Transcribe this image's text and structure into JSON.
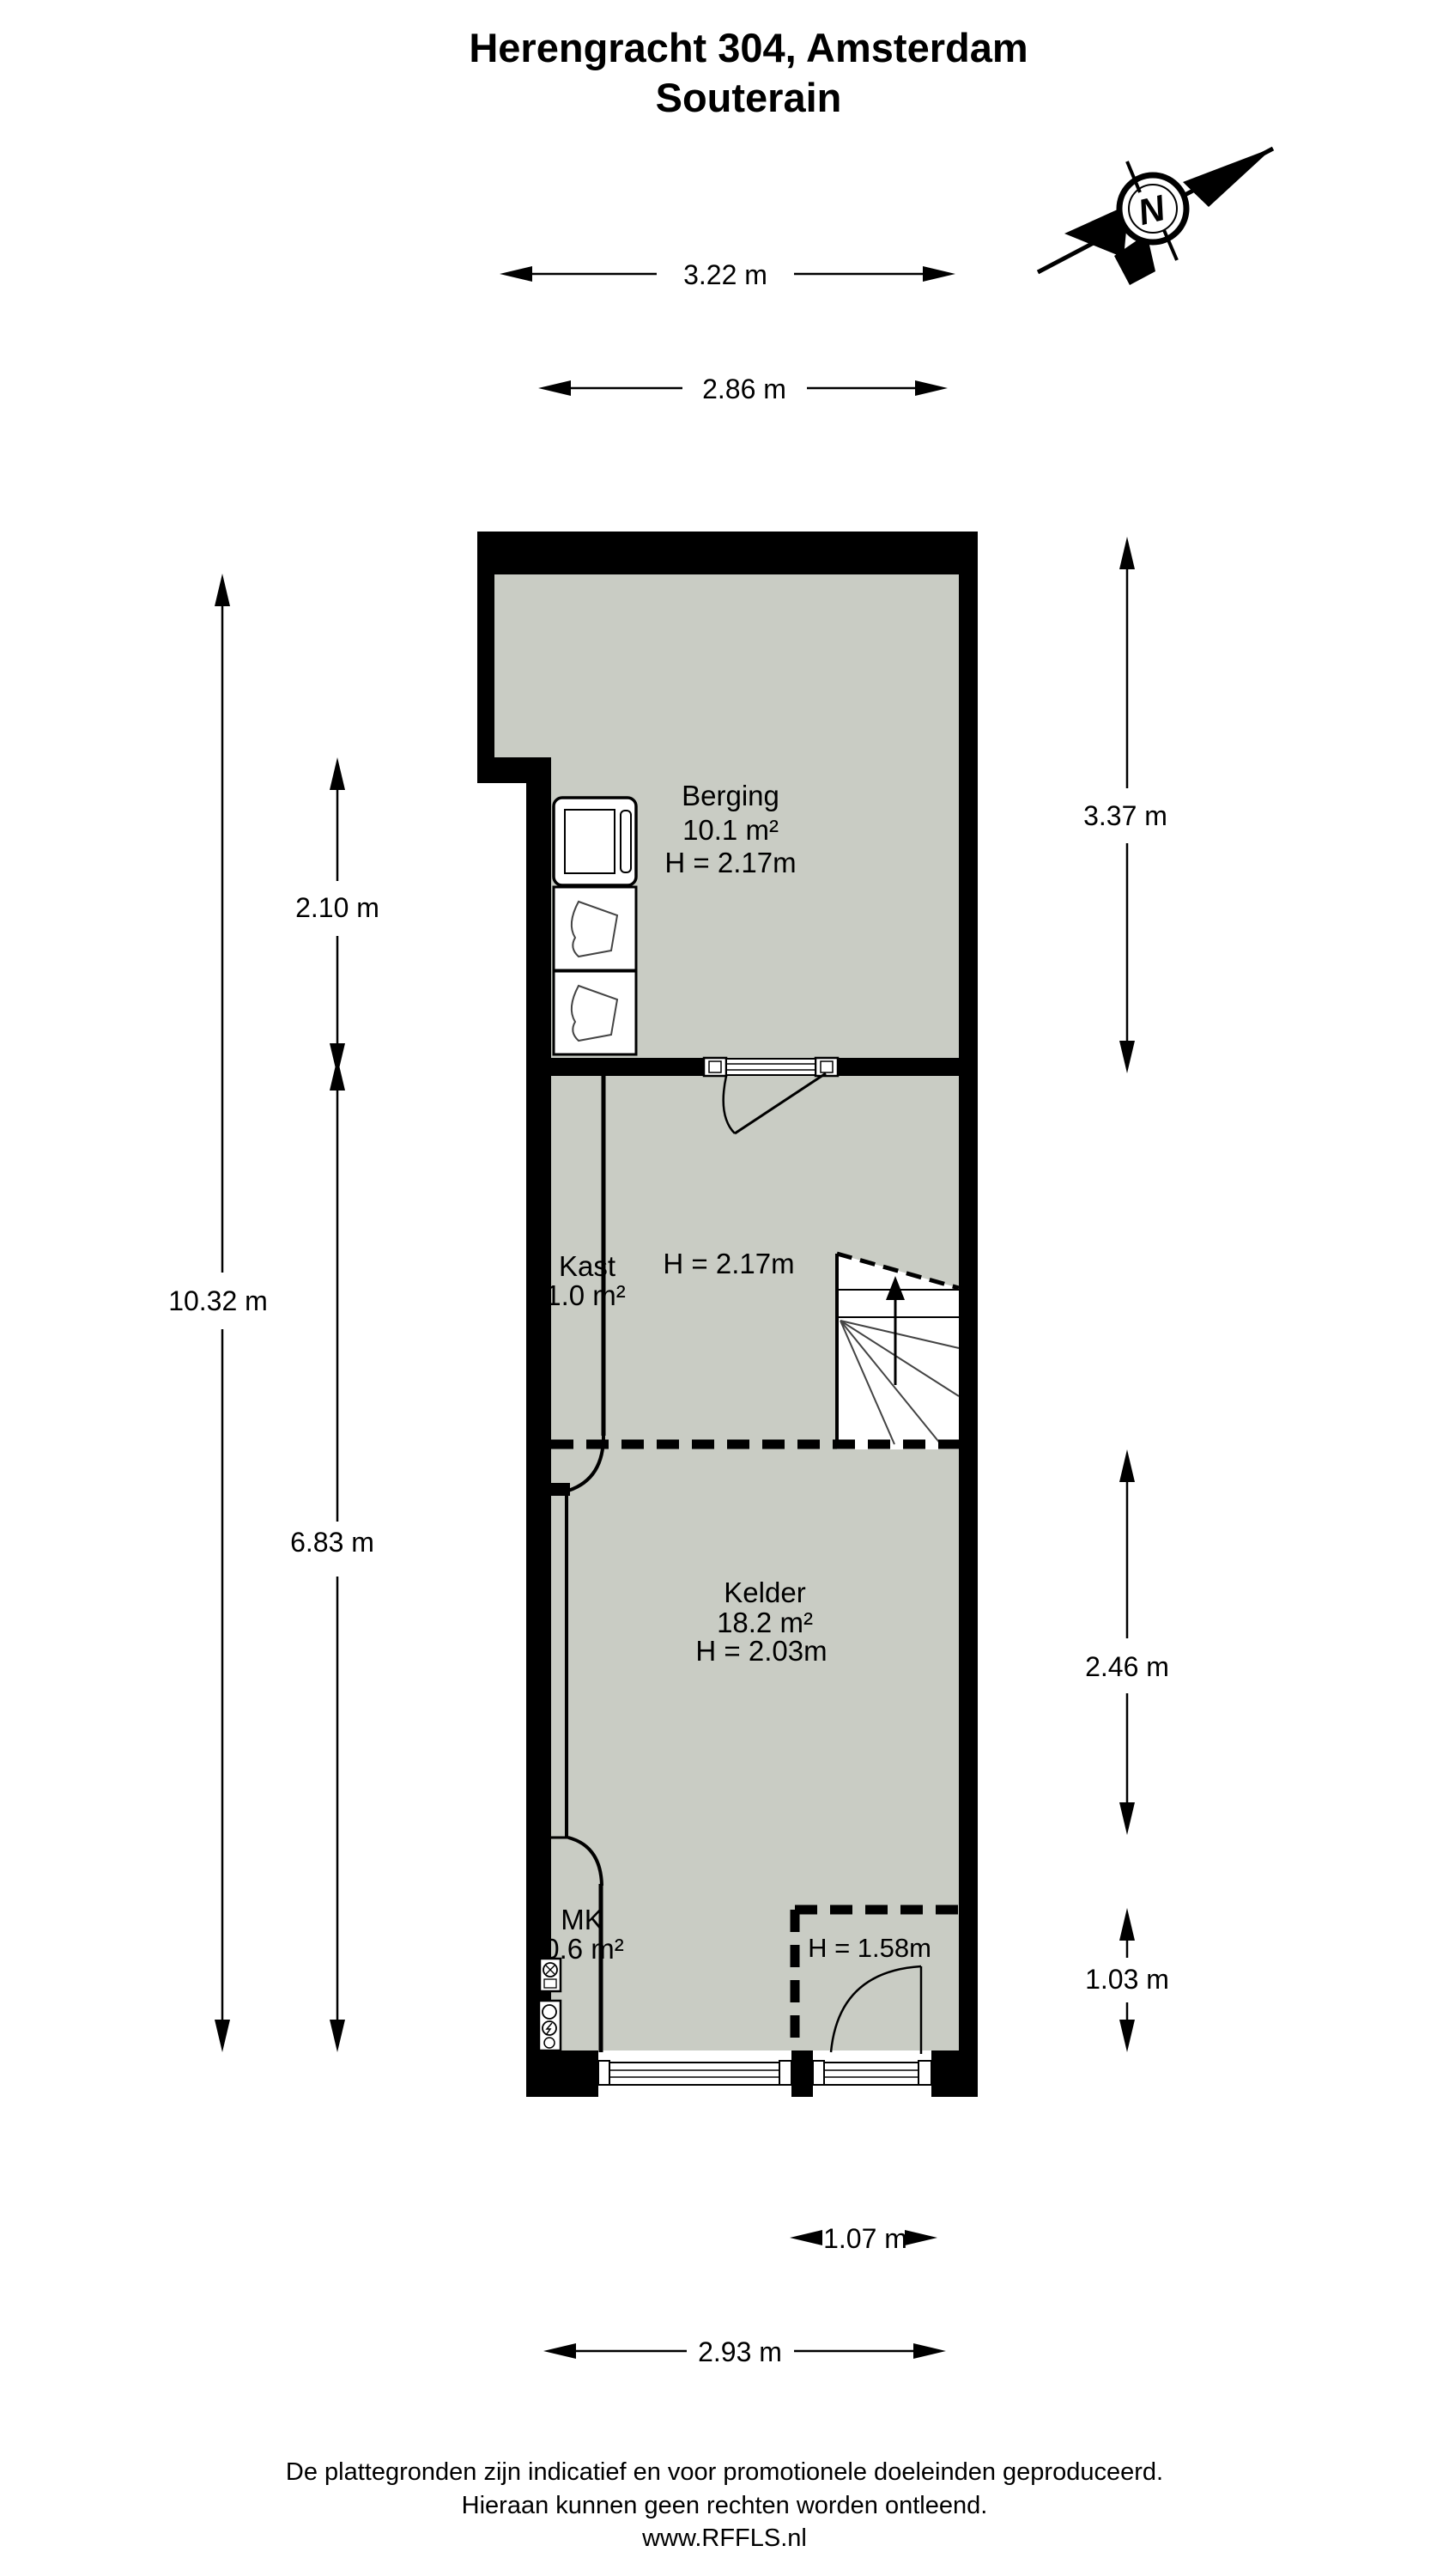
{
  "title": {
    "line1": "Herengracht 304, Amsterdam",
    "line2": "Souterain"
  },
  "compass": {
    "label": "N"
  },
  "rooms": {
    "berging": {
      "name": "Berging",
      "area": "10.1 m²",
      "height": "H = 2.17m"
    },
    "kast": {
      "name": "Kast",
      "area": "1.0 m²",
      "height": "H = 2.17m"
    },
    "kelder": {
      "name": "Kelder",
      "area": "18.2 m²",
      "height": "H = 2.03m"
    },
    "mk": {
      "name": "MK",
      "area": "0.6 m²"
    }
  },
  "annotations": {
    "low_headroom": "H = 1.58m"
  },
  "dimensions": {
    "top_outer": "3.22 m",
    "top_inner": "2.86 m",
    "left_upper": "2.10 m",
    "left_full": "10.32 m",
    "left_lower": "6.83 m",
    "right_upper": "3.37 m",
    "right_middle": "2.46 m",
    "right_lower": "1.03 m",
    "bottom_door": "1.07 m",
    "bottom_width": "2.93 m"
  },
  "footer": {
    "line1": "De plattegronden zijn indicatief en voor promotionele doeleinden geproduceerd.",
    "line2": "Hieraan kunnen geen rechten worden ontleend.",
    "line3": "www.RFFLS.nl"
  },
  "colors": {
    "floor": "#c9ccc4",
    "wall": "#000000",
    "background": "#ffffff"
  }
}
